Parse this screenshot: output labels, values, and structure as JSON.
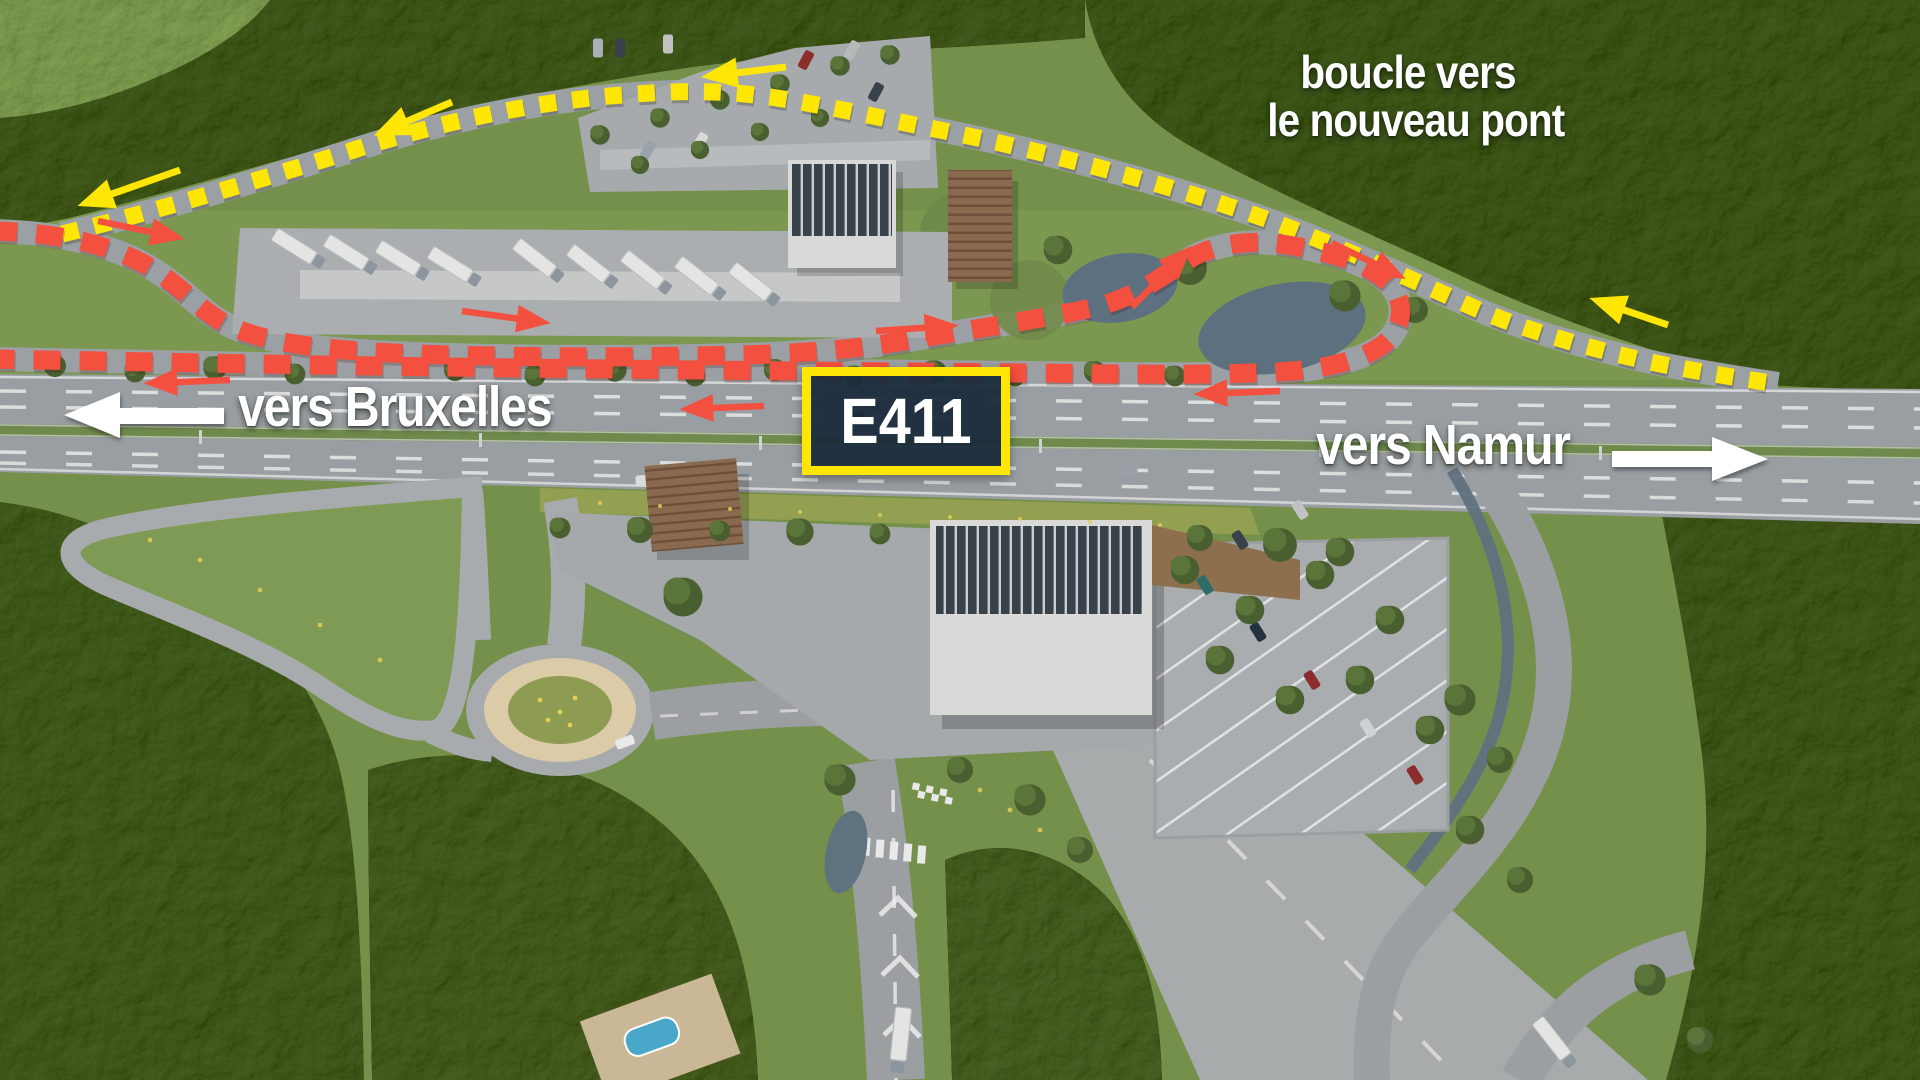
{
  "annotations": {
    "loop_label": {
      "line1": "boucle vers",
      "line2": "le nouveau pont"
    },
    "direction_left": {
      "label": "vers Bruxelles"
    },
    "direction_right": {
      "label": "vers Namur"
    },
    "road_badge": {
      "label": "E411"
    }
  },
  "colors": {
    "loop_route": "#ffe605",
    "access_route": "#f4503f",
    "direction_text": "#ffffff",
    "badge_background": "#192a3c",
    "badge_border": "#ffe605",
    "badge_text": "#ffffff"
  }
}
